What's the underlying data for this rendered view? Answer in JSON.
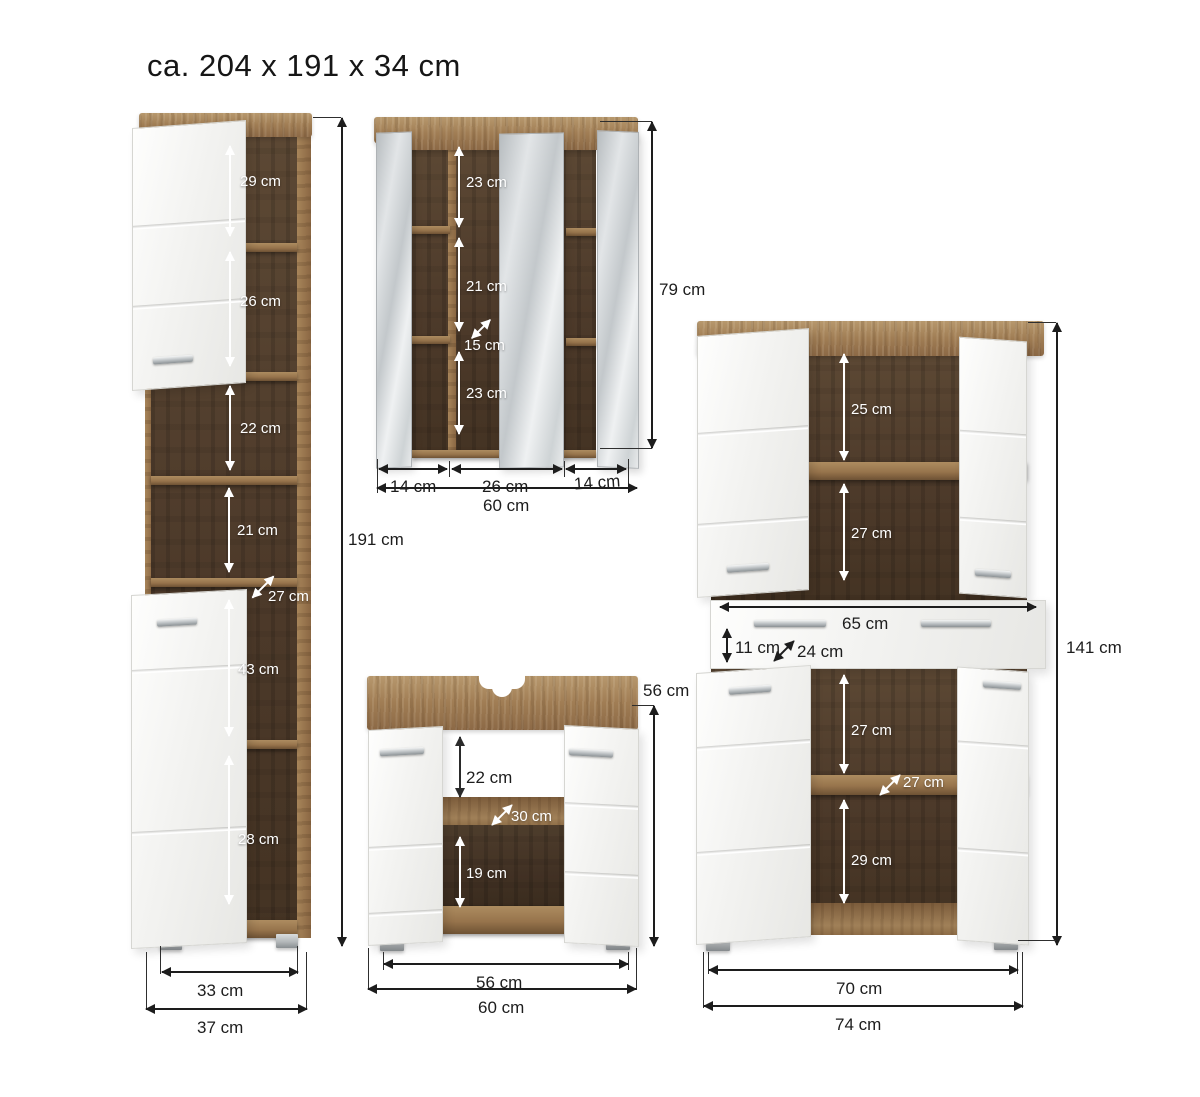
{
  "title": "ca. 204 x 191 x 34 cm",
  "tall_cabinet": {
    "height": "191 cm",
    "compartments": [
      "29 cm",
      "26 cm",
      "22 cm",
      "21 cm",
      "43 cm",
      "28 cm"
    ],
    "depth": "27 cm",
    "width_inner": "33 cm",
    "width_outer": "37 cm"
  },
  "mirror_cabinet": {
    "height": "79 cm",
    "compartments": [
      "23 cm",
      "21 cm",
      "23 cm"
    ],
    "depth": "15 cm",
    "section_widths": [
      "14 cm",
      "26 cm",
      "14 cm"
    ],
    "width_total": "60 cm"
  },
  "sink_cabinet": {
    "height": "56 cm",
    "compartments": [
      "22 cm",
      "19 cm"
    ],
    "depth": "30 cm",
    "width_inner": "56 cm",
    "width_outer": "60 cm"
  },
  "large_cabinet": {
    "height": "141 cm",
    "top_compartments": [
      "25 cm",
      "27 cm"
    ],
    "drawer": {
      "width": "65 cm",
      "height": "11 cm",
      "depth": "24 cm"
    },
    "bottom_compartments": [
      "27 cm",
      "29 cm"
    ],
    "depth": "27 cm",
    "width_inner": "70 cm",
    "width_outer": "74 cm"
  }
}
